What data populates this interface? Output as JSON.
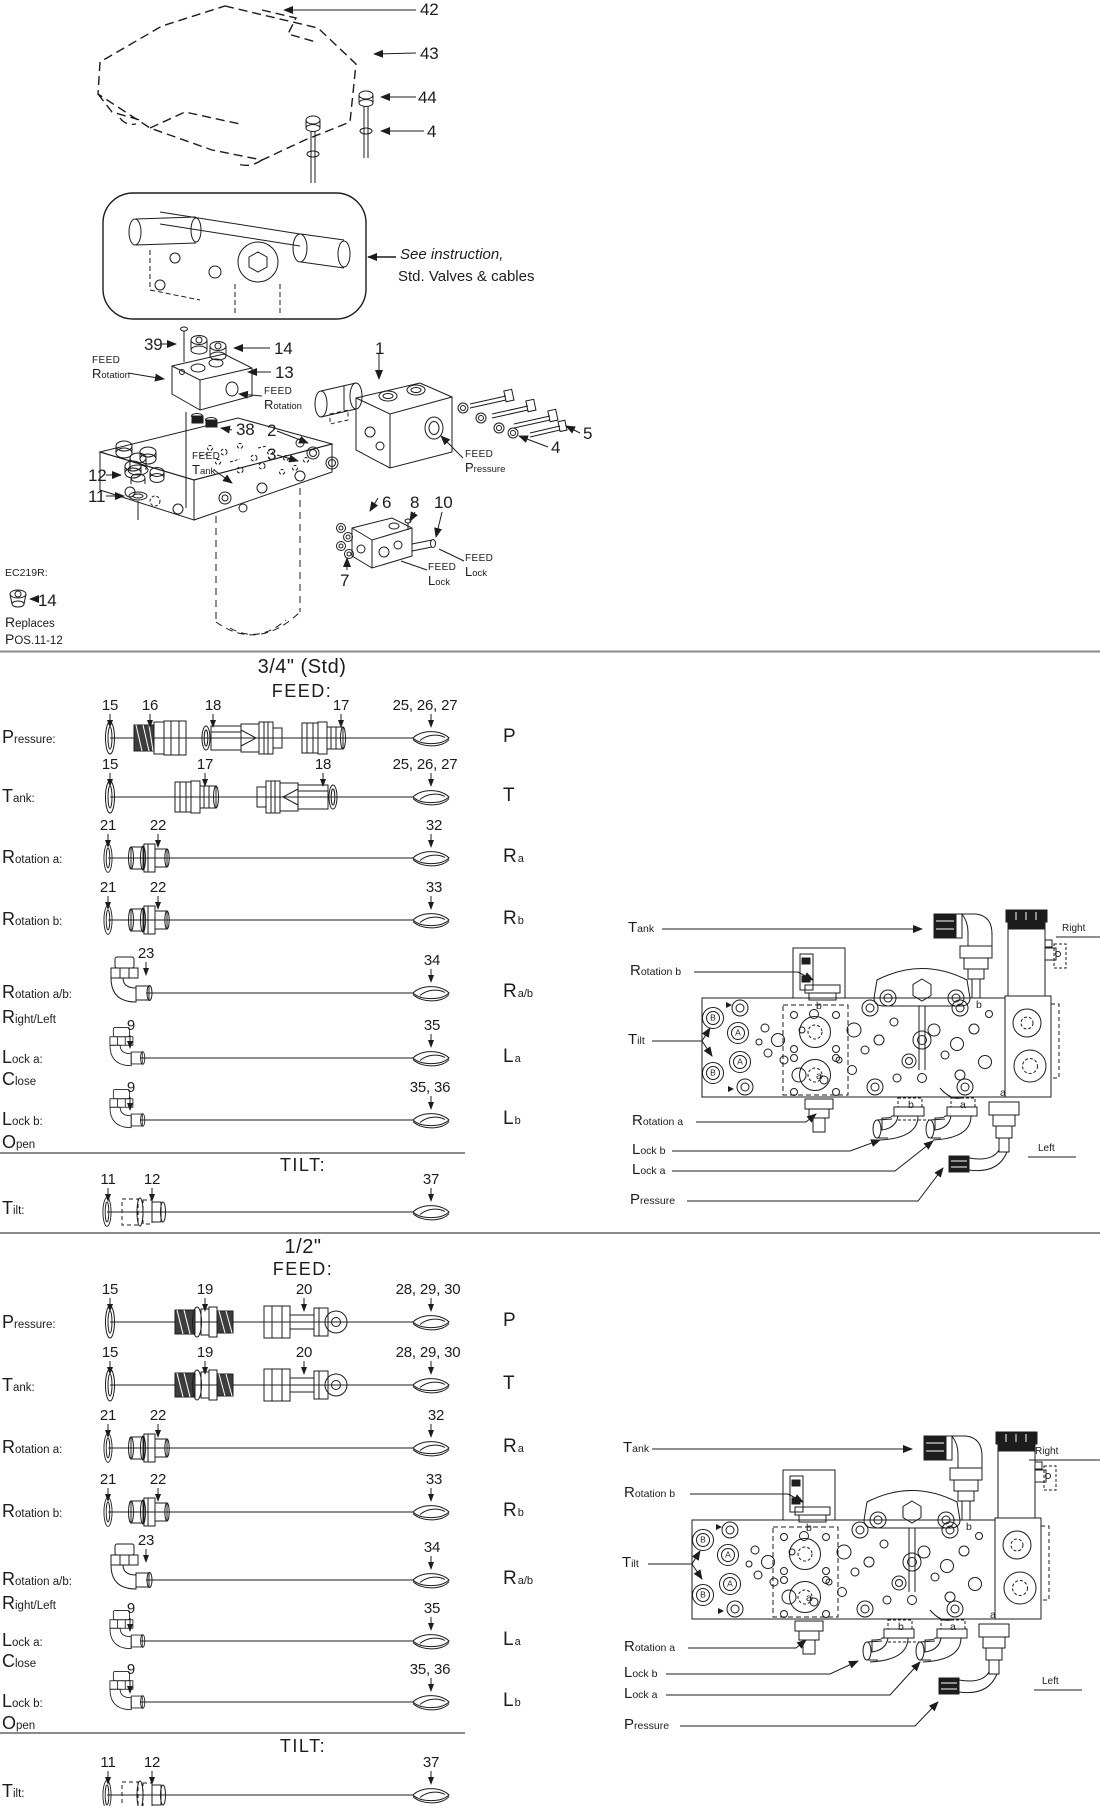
{
  "top": {
    "n42": "42",
    "n43": "43",
    "n44": "44",
    "n4": "4",
    "note1": "See instruction,",
    "note2": "Std. Valves & cables"
  },
  "exploded": {
    "n39": "39",
    "n14": "14",
    "n13": "13",
    "n38": "38",
    "n12": "12",
    "n11": "11",
    "n1": "1",
    "n2": "2",
    "n3": "3",
    "n4": "4",
    "n5": "5",
    "n6": "6",
    "n8": "8",
    "n10": "10",
    "n7": "7",
    "feed_rotation": {
      "feed": "FEED",
      "port": "Rotation"
    },
    "feed_tank": {
      "feed": "FEED",
      "port": "Tank"
    },
    "feed_pressure": {
      "feed": "FEED",
      "port": "Pressure"
    },
    "feed_lock": {
      "feed": "FEED",
      "port": "Lock"
    },
    "ec": {
      "code": "EC219R:",
      "num": "14",
      "rep1": "Replaces",
      "rep2": "POS.11-12"
    }
  },
  "sections": [
    {
      "size_header": "3/4\" (Std)",
      "feed_header": "FEED:",
      "tilt_header": "TILT:",
      "rows": [
        {
          "label": "Pressure:",
          "letter": "P",
          "letter_sub": "",
          "callouts": [
            "15",
            "16",
            "18",
            "17",
            "25, 26, 27"
          ]
        },
        {
          "label": "Tank:",
          "letter": "T",
          "letter_sub": "",
          "callouts": [
            "15",
            "17",
            "18",
            "25, 26, 27"
          ]
        },
        {
          "label": "Rotation a:",
          "letter": "R",
          "letter_sub": "a",
          "callouts": [
            "21",
            "22",
            "32"
          ]
        },
        {
          "label": "Rotation b:",
          "letter": "R",
          "letter_sub": "b",
          "callouts": [
            "21",
            "22",
            "33"
          ]
        },
        {
          "label": "Rotation a/b:",
          "sublabel": "Right/Left",
          "letter": "R",
          "letter_sub": "a/b",
          "callouts": [
            "23",
            "34"
          ]
        },
        {
          "label": "Lock a:",
          "sublabel": "Close",
          "letter": "L",
          "letter_sub": "a",
          "callouts": [
            "9",
            "35"
          ]
        },
        {
          "label": "Lock b:",
          "sublabel": "Open",
          "letter": "L",
          "letter_sub": "b",
          "callouts": [
            "9",
            "35, 36"
          ]
        }
      ],
      "tilt_row": {
        "label": "Tilt:",
        "callouts": [
          "11",
          "12",
          "37"
        ]
      }
    },
    {
      "size_header": "1/2\"",
      "feed_header": "FEED:",
      "tilt_header": "TILT:",
      "rows": [
        {
          "label": "Pressure:",
          "letter": "P",
          "letter_sub": "",
          "callouts": [
            "15",
            "19",
            "20",
            "28, 29, 30"
          ]
        },
        {
          "label": "Tank:",
          "letter": "T",
          "letter_sub": "",
          "callouts": [
            "15",
            "19",
            "20",
            "28, 29, 30"
          ]
        },
        {
          "label": "Rotation a:",
          "letter": "R",
          "letter_sub": "a",
          "callouts": [
            "21",
            "22",
            "32"
          ]
        },
        {
          "label": "Rotation b:",
          "letter": "R",
          "letter_sub": "b",
          "callouts": [
            "21",
            "22",
            "33"
          ]
        },
        {
          "label": "Rotation a/b:",
          "sublabel": "Right/Left",
          "letter": "R",
          "letter_sub": "a/b",
          "callouts": [
            "23",
            "34"
          ]
        },
        {
          "label": "Lock a:",
          "sublabel": "Close",
          "letter": "L",
          "letter_sub": "a",
          "callouts": [
            "9",
            "35"
          ]
        },
        {
          "label": "Lock b:",
          "sublabel": "Open",
          "letter": "L",
          "letter_sub": "b",
          "callouts": [
            "9",
            "35, 36"
          ]
        }
      ],
      "tilt_row": {
        "label": "Tilt:",
        "callouts": [
          "11",
          "12",
          "37"
        ]
      }
    }
  ],
  "diagram": {
    "tank": "Tank",
    "rotation_b": "Rotation b",
    "tilt": "Tilt",
    "rotation_a": "Rotation a",
    "lock_b": "Lock b",
    "lock_a": "Lock a",
    "pressure": "Pressure",
    "right": "Right",
    "left": "Left",
    "port_a": "a",
    "port_b": "b",
    "valve_a": "A",
    "valve_b": "B"
  }
}
